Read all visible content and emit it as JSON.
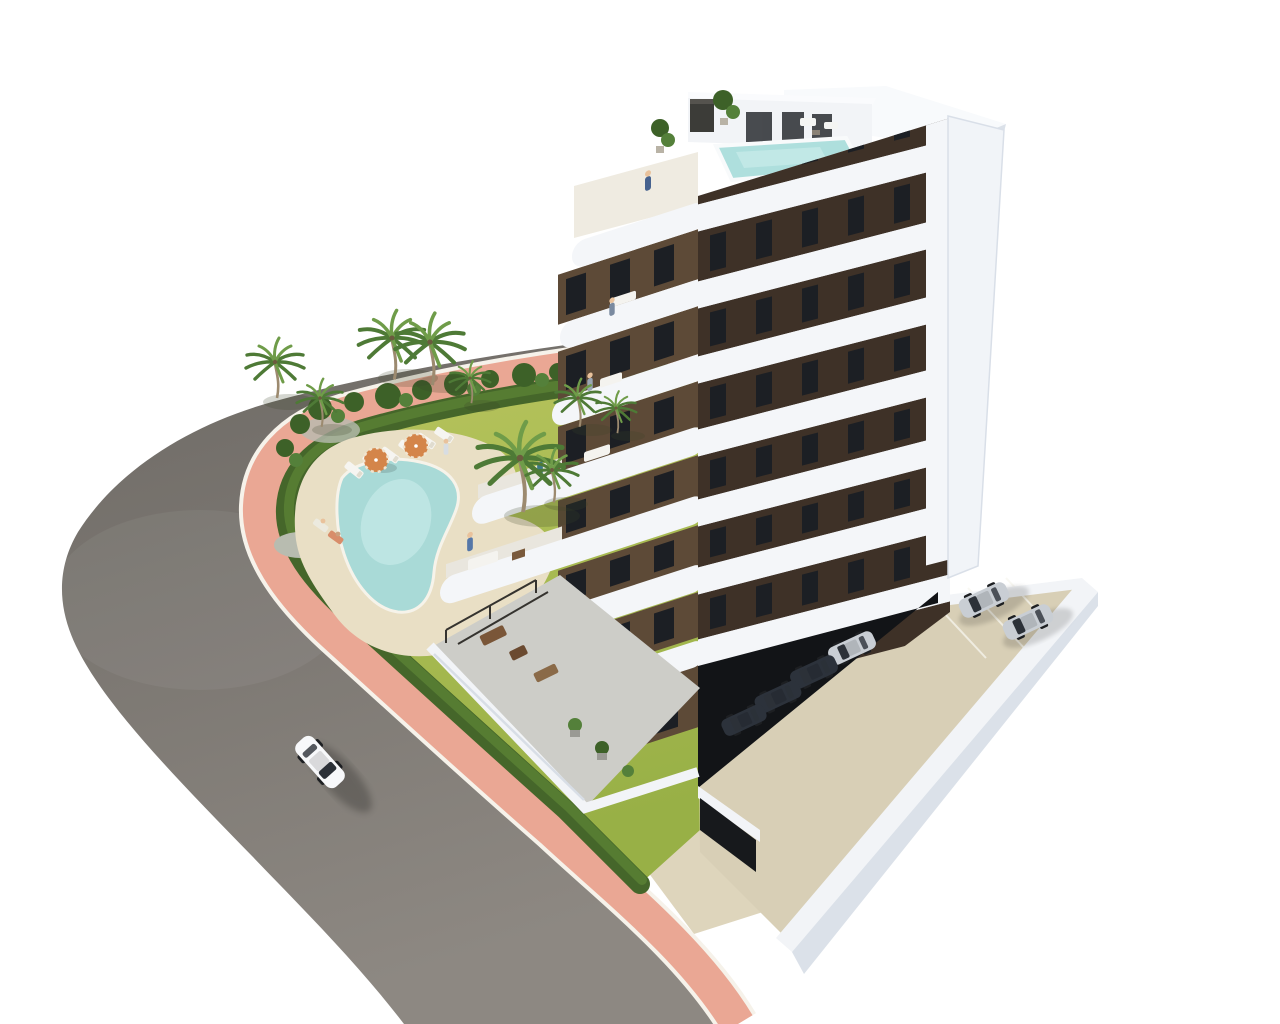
{
  "scene": {
    "kind": "3d-architectural-render",
    "view": "aerial corner view",
    "subject": "modern white apartment building with dark brown window bands, wrap-around balconies, rooftop pool, landscaped pool garden, curved corner road and open parking court",
    "background": "#ffffff"
  },
  "colors": {
    "bg": "#ffffff",
    "road_far": "#6e6a65",
    "road_near": "#8d8882",
    "sidewalk": "#eaa794",
    "curb": "#f6f2ea",
    "hedge_dark": "#45662a",
    "hedge_light": "#587e33",
    "grass_top": "#b7c45d",
    "grass_bottom": "#98b046",
    "bed_green": "#3d6128",
    "bed_green2": "#54803a",
    "gravel": "#b8bcb0",
    "deck": "#e9dfc5",
    "pool_water": "#a9dad7",
    "pool_light": "#cdeeec",
    "rooftop_pool": "#aedfdd",
    "roof_white": "#f8fafc",
    "band_white": "#f4f6f9",
    "face_right_base": "#e7ebf1",
    "facade_right": "#3e3127",
    "facade_left": "#5d4a37",
    "window_dark": "#1c1f24",
    "pillar_white": "#f1f4f8",
    "wall_white": "#f2f4f7",
    "wall_shade": "#dbe1e9",
    "undercroft": "#121417",
    "parking_slab": "#d8cfb6",
    "driveway": "#ded5bc",
    "terrace_floor": "#cdcdc8",
    "car_silver": "#c9ced4",
    "car_dark": "#2c323b",
    "car_white": "#f7f8fa",
    "palm_frond": "#4e7a36",
    "palm_frond_light": "#6f9c49",
    "palm_trunk": "#9c8a6f",
    "parasol": "#d4854a",
    "parasol_stripe": "#f1e4cf"
  },
  "building": {
    "storeys_visible": 8,
    "balcony_style": "rounded white bands",
    "rooftop_pool": true,
    "roof_terraces": 2,
    "ground_floor_terrace": true
  },
  "garden": {
    "pool_shape": "freeform",
    "sun_loungers": 6,
    "parasols": 2,
    "palm_trees": 9,
    "sunbathers": 2,
    "hedge_border": true
  },
  "vehicles": {
    "white_car_on_road": 1,
    "silver_parked": 3,
    "dark_parked": 3
  },
  "people": {
    "on_balconies_and_roof": 5,
    "by_pool": 3
  },
  "road": {
    "surface": "asphalt",
    "sidewalk_finish": "terracotta pink with white curbs",
    "layout": "curved corner street"
  }
}
